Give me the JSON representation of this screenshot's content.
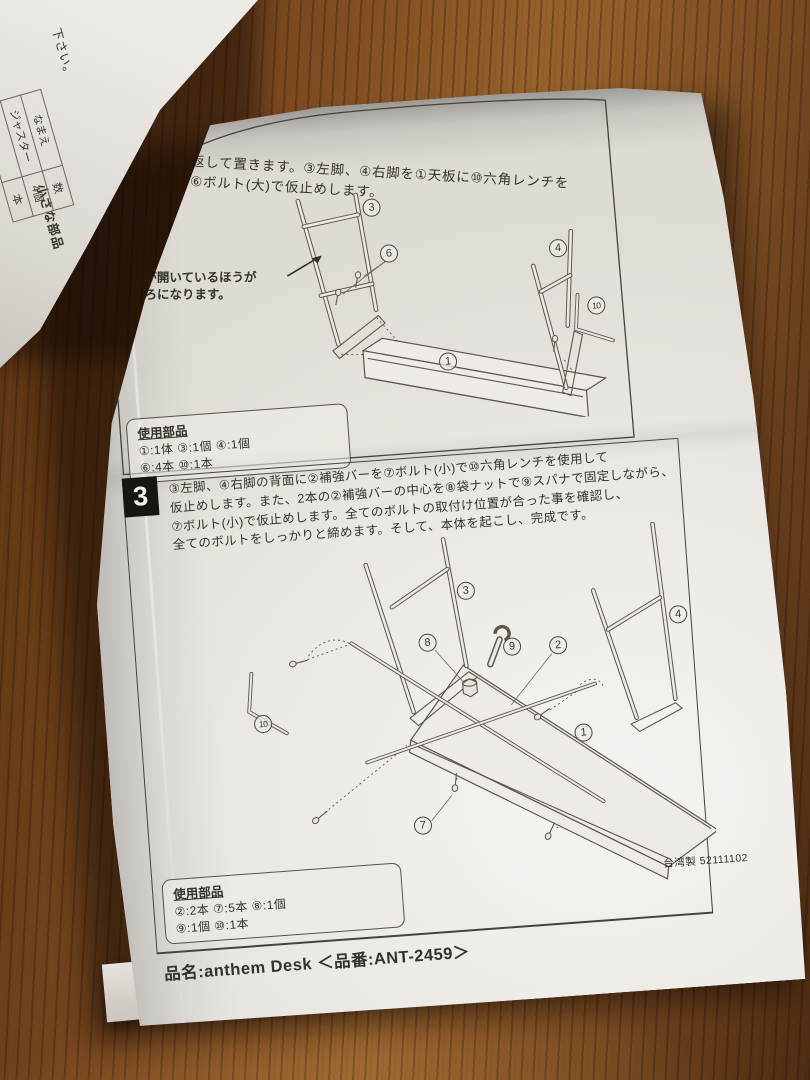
{
  "colors": {
    "wood_dark": "#3a2012",
    "wood_mid": "#7b4a20",
    "wood_light": "#99642e",
    "paper": "#e9e6e1",
    "paper_bright": "#f5f3ef",
    "ink": "#35312b",
    "diagram_line": "#5b564e"
  },
  "under_sheet": {
    "partial_line": "下さい。",
    "caption": "小さな部品",
    "table": {
      "headers": [
        "なまえ",
        "数"
      ],
      "rows": [
        [
          "ジャスター",
          "4個"
        ],
        [
          "",
          "本"
        ]
      ]
    }
  },
  "step2": {
    "text_line1": "①天板を裏返して置きます。③左脚、④右脚を①天板に⑩六角レンチを",
    "text_line2": "使用して、⑥ボルト(大)で仮止めします。",
    "note_line1": "穴が開いているほうが",
    "note_line2": "後ろになります。",
    "diagram_labels": [
      {
        "part": "left-leg",
        "num": "3"
      },
      {
        "part": "bolt-large",
        "num": "6"
      },
      {
        "part": "right-leg",
        "num": "4"
      },
      {
        "part": "hex-wrench",
        "num": "10"
      },
      {
        "part": "top-board",
        "num": "1"
      }
    ],
    "parts_box": {
      "title": "使用部品",
      "line1": "①:1体 ③:1個 ④:1個",
      "line2": "⑥:4本 ⑩:1本"
    }
  },
  "step3": {
    "number": "3",
    "text_lines": [
      "③左脚、④右脚の背面に②補強バーを⑦ボルト(小)で⑩六角レンチを使用して",
      "仮止めします。また、2本の②補強バーの中心を⑧袋ナットで⑨スパナで固定しながら、",
      "⑦ボルト(小)で仮止めします。全てのボルトの取付け位置が合った事を確認し、",
      "全てのボルトをしっかりと締めます。そして、本体を起こし、完成です。"
    ],
    "diagram_labels": [
      {
        "part": "left-leg",
        "num": "3"
      },
      {
        "part": "right-leg",
        "num": "4"
      },
      {
        "part": "cap-nut",
        "num": "8"
      },
      {
        "part": "spanner",
        "num": "9"
      },
      {
        "part": "brace-bar",
        "num": "2"
      },
      {
        "part": "hex-wrench",
        "num": "10"
      },
      {
        "part": "top-board",
        "num": "1"
      },
      {
        "part": "bolt-small",
        "num": "7"
      }
    ],
    "parts_box": {
      "title": "使用部品",
      "line1": "②:2本 ⑦:5本 ⑧:1個",
      "line2": "⑨:1個 ⑩:1本"
    }
  },
  "footer": {
    "made_in": "台湾製 52111102",
    "product_line": "品名:anthem Desk ＜品番:ANT-2459＞"
  }
}
